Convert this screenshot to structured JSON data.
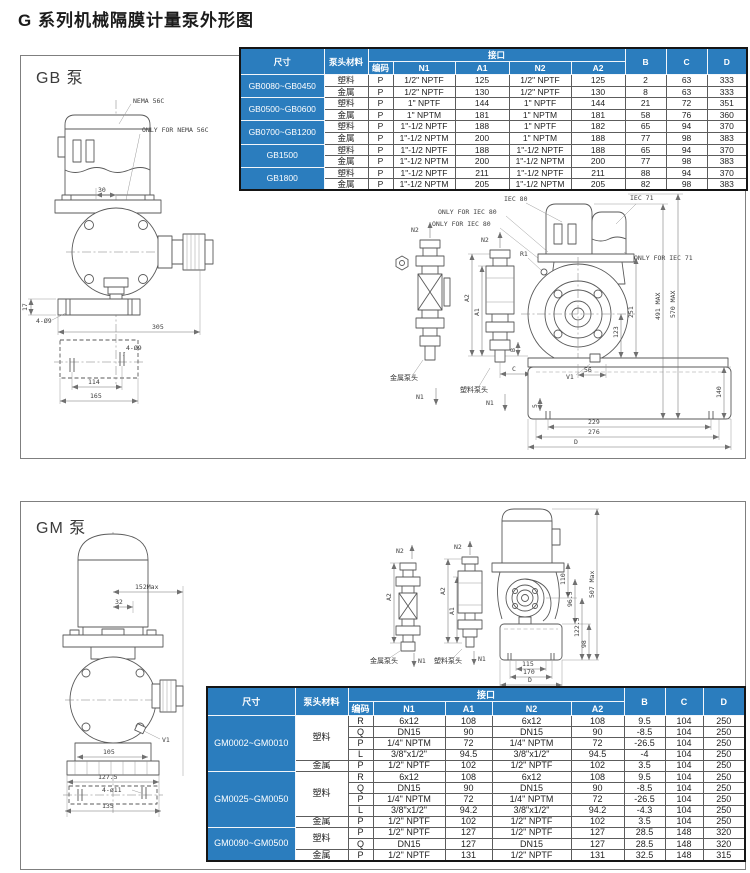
{
  "page": {
    "title": "G 系列机械隔膜计量泵外形图"
  },
  "labels": {
    "n1": "N1",
    "n2": "N2",
    "a1": "A1",
    "a2": "A2",
    "v1": "V1",
    "r1": "R1",
    "b": "B",
    "c": "C",
    "metal_head": "金属泵头",
    "plastic_head": "塑料泵头"
  },
  "colors": {
    "header_blue": "#2b7dbe",
    "line_gray": "#5a5a5a"
  },
  "gb": {
    "panel_label": "GB 泵",
    "front": {
      "nema": "NEMA 56C",
      "only_nema": "ONLY FOR NEMA 56C",
      "dims": {
        "motor_offset": "30",
        "base_height": "17",
        "holes_front": "4-Ø9",
        "depth": "305",
        "holes_plan": "4-Ø9",
        "hole_span": "114",
        "base_width": "165"
      }
    },
    "side": {
      "iec80": "IEC 80",
      "iec71": "IEC 71",
      "only_iec80_a": "ONLY FOR IEC 80",
      "only_iec80_b": "ONLY FOR IEC 80",
      "only_iec71": "ONLY FOR IEC 71",
      "dims": {
        "d123": "123",
        "d251": "251",
        "d491": "491 MAX",
        "d570": "570 MAX",
        "d140": "140",
        "d56": "56",
        "d5": "5",
        "d229": "229",
        "d276": "276",
        "dd": "D"
      }
    },
    "table": {
      "h_size": "尺寸",
      "h_material": "泵头材料",
      "h_interface": "接口",
      "h_code": "编码",
      "h_n1": "N1",
      "h_a1": "A1",
      "h_n2": "N2",
      "h_a2": "A2",
      "h_b": "B",
      "h_c": "C",
      "h_d": "D",
      "sizes": [
        "GB0080~GB0450",
        "GB0500~GB0600",
        "GB0700~GB1200",
        "GB1500",
        "GB1800"
      ],
      "rows": [
        [
          "塑料",
          "P",
          "1/2\" NPTF",
          "125",
          "1/2\" NPTF",
          "125",
          "2",
          "63",
          "333"
        ],
        [
          "金属",
          "P",
          "1/2\" NPTF",
          "130",
          "1/2\" NPTF",
          "130",
          "8",
          "63",
          "333"
        ],
        [
          "塑料",
          "P",
          "1\" NPTF",
          "144",
          "1\" NPTF",
          "144",
          "21",
          "72",
          "351"
        ],
        [
          "金属",
          "P",
          "1\" NPTM",
          "181",
          "1\" NPTM",
          "181",
          "58",
          "76",
          "360"
        ],
        [
          "塑料",
          "P",
          "1\"-1/2 NPTF",
          "188",
          "1\" NPTF",
          "182",
          "65",
          "94",
          "370"
        ],
        [
          "金属",
          "P",
          "1\"-1/2 NPTM",
          "200",
          "1\" NPTM",
          "188",
          "77",
          "98",
          "383"
        ],
        [
          "塑料",
          "P",
          "1\"-1/2 NPTF",
          "188",
          "1\"-1/2 NPTF",
          "188",
          "65",
          "94",
          "370"
        ],
        [
          "金属",
          "P",
          "1\"-1/2 NPTM",
          "200",
          "1\"-1/2 NPTM",
          "200",
          "77",
          "98",
          "383"
        ],
        [
          "塑料",
          "P",
          "1\"-1/2 NPTF",
          "211",
          "1\"-1/2 NPTF",
          "211",
          "88",
          "94",
          "370"
        ],
        [
          "金属",
          "P",
          "1\"-1/2 NPTM",
          "205",
          "1\"-1/2 NPTM",
          "205",
          "82",
          "98",
          "383"
        ]
      ]
    }
  },
  "gm": {
    "panel_label": "GM 泵",
    "front": {
      "dims": {
        "reach": "152Max",
        "offset": "32",
        "d105": "105",
        "d1275": "127.5",
        "holes": "4-ø11",
        "d135": "135"
      }
    },
    "side": {
      "dims": {
        "d110": "110",
        "d965": "96.5",
        "d1225": "122.5",
        "d98": "98",
        "dmax": "507 Max",
        "d115": "115",
        "d170": "170",
        "dd": "D"
      }
    },
    "table": {
      "h_size": "尺寸",
      "h_material": "泵头材料",
      "h_interface": "接口",
      "h_code": "编码",
      "h_n1": "N1",
      "h_a1": "A1",
      "h_n2": "N2",
      "h_a2": "A2",
      "h_b": "B",
      "h_c": "C",
      "h_d": "D",
      "sizes": [
        "GM0002~GM0010",
        "GM0025~GM0050",
        "GM0090~GM0500"
      ],
      "materials": [
        "塑料",
        "金属",
        "塑料",
        "金属",
        "塑料",
        "金属"
      ],
      "rows": [
        [
          "R",
          "6x12",
          "108",
          "6x12",
          "108",
          "9.5",
          "104",
          "250"
        ],
        [
          "Q",
          "DN15",
          "90",
          "DN15",
          "90",
          "-8.5",
          "104",
          "250"
        ],
        [
          "P",
          "1/4\" NPTM",
          "72",
          "1/4\" NPTM",
          "72",
          "-26.5",
          "104",
          "250"
        ],
        [
          "L",
          "3/8\"x1/2\"",
          "94.5",
          "3/8\"x1/2\"",
          "94.5",
          "-4",
          "104",
          "250"
        ],
        [
          "P",
          "1/2\" NPTF",
          "102",
          "1/2\" NPTF",
          "102",
          "3.5",
          "104",
          "250"
        ],
        [
          "R",
          "6x12",
          "108",
          "6x12",
          "108",
          "9.5",
          "104",
          "250"
        ],
        [
          "Q",
          "DN15",
          "90",
          "DN15",
          "90",
          "-8.5",
          "104",
          "250"
        ],
        [
          "P",
          "1/4\" NPTM",
          "72",
          "1/4\" NPTM",
          "72",
          "-26.5",
          "104",
          "250"
        ],
        [
          "L",
          "3/8\"x1/2\"",
          "94.2",
          "3/8\"x1/2\"",
          "94.2",
          "-4.3",
          "104",
          "250"
        ],
        [
          "P",
          "1/2\" NPTF",
          "102",
          "1/2\" NPTF",
          "102",
          "3.5",
          "104",
          "250"
        ],
        [
          "P",
          "1/2\" NPTF",
          "127",
          "1/2\" NPTF",
          "127",
          "28.5",
          "148",
          "320"
        ],
        [
          "Q",
          "DN15",
          "127",
          "DN15",
          "127",
          "28.5",
          "148",
          "320"
        ],
        [
          "P",
          "1/2\" NPTF",
          "131",
          "1/2\" NPTF",
          "131",
          "32.5",
          "148",
          "315"
        ]
      ]
    }
  }
}
